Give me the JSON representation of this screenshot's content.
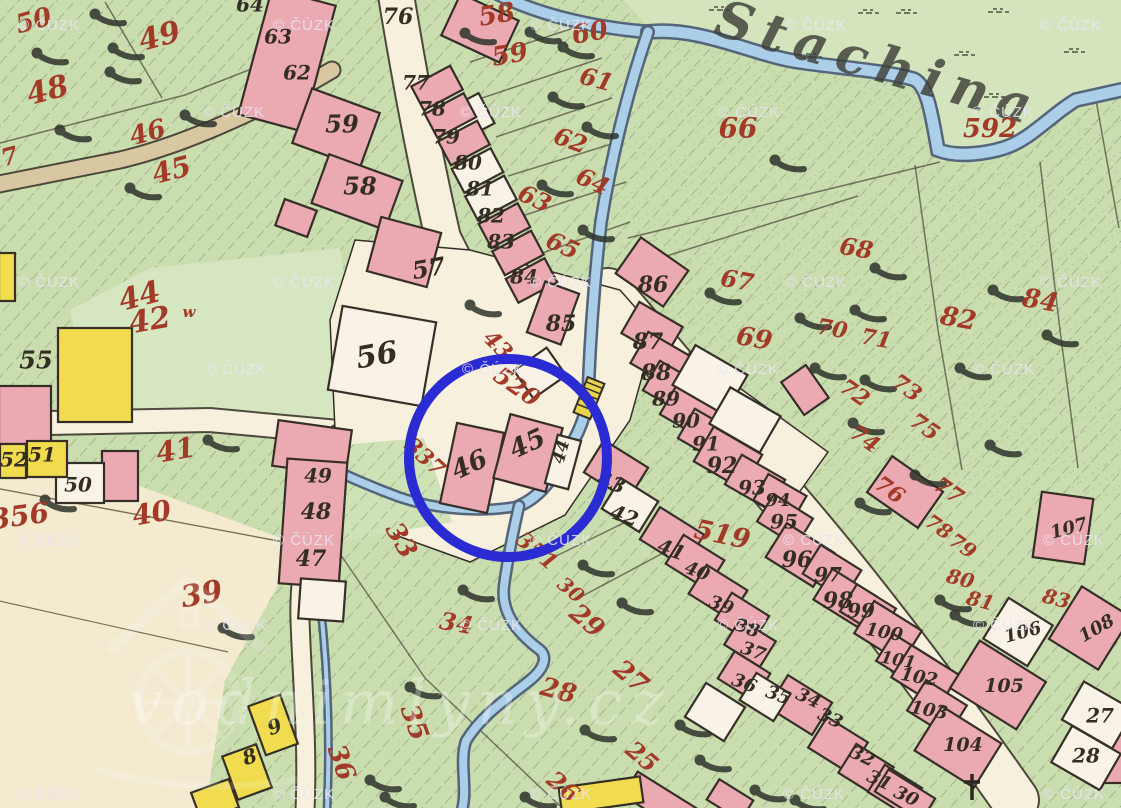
{
  "map": {
    "river_label": "Stachina",
    "site_watermark": "vodnimlyny.cz",
    "copyright_watermark": {
      "text": "© ČÚZK",
      "positions": [
        [
          18,
          18
        ],
        [
          273,
          18
        ],
        [
          530,
          18
        ],
        [
          785,
          18
        ],
        [
          1040,
          18
        ],
        [
          203,
          105
        ],
        [
          460,
          105
        ],
        [
          718,
          105
        ],
        [
          972,
          105
        ],
        [
          18,
          275
        ],
        [
          273,
          275
        ],
        [
          530,
          275
        ],
        [
          785,
          275
        ],
        [
          1040,
          275
        ],
        [
          205,
          362
        ],
        [
          462,
          362
        ],
        [
          717,
          362
        ],
        [
          973,
          362
        ],
        [
          18,
          533
        ],
        [
          273,
          533
        ],
        [
          530,
          533
        ],
        [
          783,
          533
        ],
        [
          1043,
          533
        ],
        [
          205,
          618
        ],
        [
          460,
          618
        ],
        [
          717,
          618
        ],
        [
          973,
          618
        ],
        [
          18,
          787
        ],
        [
          273,
          787
        ],
        [
          530,
          787
        ],
        [
          783,
          787
        ],
        [
          1043,
          787
        ]
      ]
    },
    "annotation_circle": {
      "cx": 508,
      "cy": 458,
      "r": 99,
      "color": "#2b2bd4",
      "stroke_width": 10
    },
    "colors": {
      "paper": "#f7f0dc",
      "field": "#f3ead0",
      "meadow": "#d4e5bd",
      "meadow2": "#d6e6c0",
      "green": "#c9ddae",
      "patch": "#cfe2b6",
      "pink": "#eba9b2",
      "white_bldg": "#f8f3e6",
      "yellow": "#f0dc4e",
      "tan": "#d9c7a2",
      "stream_fill": "#abcfe8",
      "stream_edge": "#54657a",
      "outline": "#352f28",
      "red_ink": "#a33a28",
      "black_ink": "#332d24",
      "watermark": "#e9e5f3",
      "tree": "#2f332c",
      "bridge": "#e8d44d"
    },
    "parcel_numbers_red": [
      {
        "t": "50",
        "x": 34,
        "y": 22,
        "r": -15,
        "s": 26
      },
      {
        "t": "49",
        "x": 160,
        "y": 38,
        "r": -15,
        "s": 30
      },
      {
        "t": "48",
        "x": 48,
        "y": 92,
        "r": -15,
        "s": 30
      },
      {
        "t": "46",
        "x": 148,
        "y": 134,
        "r": -15,
        "s": 26
      },
      {
        "t": "45",
        "x": 172,
        "y": 172,
        "r": -15,
        "s": 28
      },
      {
        "t": "7",
        "x": 10,
        "y": 158,
        "r": -15,
        "s": 24
      },
      {
        "t": "44",
        "x": 140,
        "y": 298,
        "r": -15,
        "s": 30
      },
      {
        "t": "42",
        "x": 150,
        "y": 322,
        "r": -10,
        "s": 30
      },
      {
        "t": "w",
        "x": 189,
        "y": 313,
        "r": 0,
        "s": 15
      },
      {
        "t": "41",
        "x": 176,
        "y": 452,
        "r": -10,
        "s": 28
      },
      {
        "t": "40",
        "x": 152,
        "y": 515,
        "r": -10,
        "s": 28
      },
      {
        "t": "356",
        "x": 20,
        "y": 518,
        "r": -8,
        "s": 28
      },
      {
        "t": "39",
        "x": 202,
        "y": 596,
        "r": -10,
        "s": 30
      },
      {
        "t": "33",
        "x": 400,
        "y": 541,
        "r": 60,
        "s": 26
      },
      {
        "t": "35",
        "x": 413,
        "y": 723,
        "r": 70,
        "s": 26
      },
      {
        "t": "36",
        "x": 340,
        "y": 763,
        "r": 70,
        "s": 26
      },
      {
        "t": "337",
        "x": 424,
        "y": 458,
        "r": 42,
        "s": 22
      },
      {
        "t": "43",
        "x": 497,
        "y": 346,
        "r": 45,
        "s": 22
      },
      {
        "t": "520",
        "x": 516,
        "y": 388,
        "r": 35,
        "s": 24
      },
      {
        "t": "519",
        "x": 722,
        "y": 536,
        "r": 12,
        "s": 27
      },
      {
        "t": "351",
        "x": 536,
        "y": 552,
        "r": 40,
        "s": 22
      },
      {
        "t": "30",
        "x": 570,
        "y": 591,
        "r": 40,
        "s": 20
      },
      {
        "t": "29",
        "x": 586,
        "y": 622,
        "r": 40,
        "s": 26
      },
      {
        "t": "28",
        "x": 558,
        "y": 692,
        "r": 15,
        "s": 26
      },
      {
        "t": "27",
        "x": 630,
        "y": 678,
        "r": 40,
        "s": 26
      },
      {
        "t": "26",
        "x": 562,
        "y": 788,
        "r": 40,
        "s": 24
      },
      {
        "t": "25",
        "x": 641,
        "y": 758,
        "r": 40,
        "s": 24
      },
      {
        "t": "34",
        "x": 456,
        "y": 625,
        "r": 10,
        "s": 24
      },
      {
        "t": "58",
        "x": 497,
        "y": 16,
        "r": -10,
        "s": 26
      },
      {
        "t": "59",
        "x": 510,
        "y": 56,
        "r": -10,
        "s": 26
      },
      {
        "t": "60",
        "x": 590,
        "y": 34,
        "r": -10,
        "s": 26
      },
      {
        "t": "61",
        "x": 596,
        "y": 81,
        "r": 15,
        "s": 24
      },
      {
        "t": "62",
        "x": 570,
        "y": 142,
        "r": 20,
        "s": 24
      },
      {
        "t": "63",
        "x": 534,
        "y": 200,
        "r": 25,
        "s": 24
      },
      {
        "t": "64",
        "x": 592,
        "y": 183,
        "r": 25,
        "s": 24
      },
      {
        "t": "65",
        "x": 562,
        "y": 247,
        "r": 25,
        "s": 24
      },
      {
        "t": "66",
        "x": 738,
        "y": 130,
        "r": 0,
        "s": 28
      },
      {
        "t": "592",
        "x": 990,
        "y": 130,
        "r": 0,
        "s": 26
      },
      {
        "t": "67",
        "x": 737,
        "y": 282,
        "r": 10,
        "s": 24
      },
      {
        "t": "68",
        "x": 856,
        "y": 250,
        "r": 10,
        "s": 24
      },
      {
        "t": "69",
        "x": 754,
        "y": 340,
        "r": 10,
        "s": 26
      },
      {
        "t": "70",
        "x": 832,
        "y": 330,
        "r": 10,
        "s": 22
      },
      {
        "t": "71",
        "x": 876,
        "y": 340,
        "r": 10,
        "s": 22
      },
      {
        "t": "72",
        "x": 854,
        "y": 394,
        "r": 35,
        "s": 22
      },
      {
        "t": "73",
        "x": 906,
        "y": 389,
        "r": 35,
        "s": 22
      },
      {
        "t": "74",
        "x": 864,
        "y": 440,
        "r": 35,
        "s": 22
      },
      {
        "t": "75",
        "x": 924,
        "y": 428,
        "r": 35,
        "s": 22
      },
      {
        "t": "76",
        "x": 889,
        "y": 491,
        "r": 35,
        "s": 22
      },
      {
        "t": "77",
        "x": 948,
        "y": 492,
        "r": 35,
        "s": 22
      },
      {
        "t": "78",
        "x": 938,
        "y": 528,
        "r": 35,
        "s": 20
      },
      {
        "t": "79",
        "x": 962,
        "y": 547,
        "r": 35,
        "s": 20
      },
      {
        "t": "80",
        "x": 960,
        "y": 580,
        "r": 15,
        "s": 20
      },
      {
        "t": "81",
        "x": 980,
        "y": 602,
        "r": 15,
        "s": 20
      },
      {
        "t": "83",
        "x": 1056,
        "y": 600,
        "r": 15,
        "s": 20
      },
      {
        "t": "82",
        "x": 958,
        "y": 320,
        "r": 10,
        "s": 26
      },
      {
        "t": "84",
        "x": 1040,
        "y": 302,
        "r": 10,
        "s": 26
      }
    ],
    "house_numbers_black": [
      {
        "t": "64",
        "x": 250,
        "y": 6,
        "r": 0,
        "s": 20
      },
      {
        "t": "63",
        "x": 278,
        "y": 38,
        "r": 0,
        "s": 20
      },
      {
        "t": "62",
        "x": 297,
        "y": 74,
        "r": 0,
        "s": 20
      },
      {
        "t": "59",
        "x": 342,
        "y": 126,
        "r": 0,
        "s": 24
      },
      {
        "t": "58",
        "x": 360,
        "y": 188,
        "r": 0,
        "s": 24
      },
      {
        "t": "76",
        "x": 398,
        "y": 18,
        "r": 0,
        "s": 22
      },
      {
        "t": "77",
        "x": 416,
        "y": 84,
        "r": 0,
        "s": 20
      },
      {
        "t": "78",
        "x": 432,
        "y": 110,
        "r": 0,
        "s": 20
      },
      {
        "t": "79",
        "x": 446,
        "y": 138,
        "r": 0,
        "s": 20
      },
      {
        "t": "80",
        "x": 468,
        "y": 164,
        "r": 0,
        "s": 20
      },
      {
        "t": "81",
        "x": 480,
        "y": 190,
        "r": 0,
        "s": 20
      },
      {
        "t": "82",
        "x": 491,
        "y": 217,
        "r": 0,
        "s": 20
      },
      {
        "t": "83",
        "x": 501,
        "y": 243,
        "r": 0,
        "s": 20
      },
      {
        "t": "84",
        "x": 524,
        "y": 278,
        "r": 0,
        "s": 20
      },
      {
        "t": "85",
        "x": 561,
        "y": 325,
        "r": 0,
        "s": 22
      },
      {
        "t": "86",
        "x": 653,
        "y": 286,
        "r": 0,
        "s": 22
      },
      {
        "t": "87",
        "x": 648,
        "y": 343,
        "r": 0,
        "s": 22
      },
      {
        "t": "88",
        "x": 656,
        "y": 374,
        "r": 0,
        "s": 22
      },
      {
        "t": "89",
        "x": 666,
        "y": 400,
        "r": 0,
        "s": 20
      },
      {
        "t": "90",
        "x": 686,
        "y": 422,
        "r": 0,
        "s": 20
      },
      {
        "t": "91",
        "x": 706,
        "y": 445,
        "r": 0,
        "s": 20
      },
      {
        "t": "92",
        "x": 722,
        "y": 467,
        "r": 0,
        "s": 22
      },
      {
        "t": "93",
        "x": 752,
        "y": 489,
        "r": 0,
        "s": 20
      },
      {
        "t": "94",
        "x": 778,
        "y": 501,
        "r": 0,
        "s": 18
      },
      {
        "t": "95",
        "x": 784,
        "y": 523,
        "r": 0,
        "s": 20
      },
      {
        "t": "96",
        "x": 797,
        "y": 561,
        "r": 0,
        "s": 22
      },
      {
        "t": "97",
        "x": 828,
        "y": 576,
        "r": 0,
        "s": 20
      },
      {
        "t": "98",
        "x": 838,
        "y": 602,
        "r": 0,
        "s": 22
      },
      {
        "t": "99",
        "x": 861,
        "y": 612,
        "r": 0,
        "s": 20
      },
      {
        "t": "100",
        "x": 884,
        "y": 633,
        "r": 10,
        "s": 18
      },
      {
        "t": "101",
        "x": 898,
        "y": 661,
        "r": 10,
        "s": 17
      },
      {
        "t": "102",
        "x": 919,
        "y": 678,
        "r": 10,
        "s": 18
      },
      {
        "t": "103",
        "x": 929,
        "y": 711,
        "r": 10,
        "s": 18
      },
      {
        "t": "104",
        "x": 963,
        "y": 746,
        "r": 0,
        "s": 19
      },
      {
        "t": "105",
        "x": 1004,
        "y": 687,
        "r": 0,
        "s": 19
      },
      {
        "t": "106",
        "x": 1023,
        "y": 633,
        "r": -15,
        "s": 18
      },
      {
        "t": "107",
        "x": 1069,
        "y": 529,
        "r": -15,
        "s": 18
      },
      {
        "t": "108",
        "x": 1097,
        "y": 629,
        "r": -30,
        "s": 18
      },
      {
        "t": "27",
        "x": 1100,
        "y": 717,
        "r": 0,
        "s": 20
      },
      {
        "t": "28",
        "x": 1086,
        "y": 757,
        "r": 0,
        "s": 20
      },
      {
        "t": "55",
        "x": 36,
        "y": 362,
        "r": 0,
        "s": 24
      },
      {
        "t": "52",
        "x": 14,
        "y": 461,
        "r": 0,
        "s": 20
      },
      {
        "t": "51",
        "x": 42,
        "y": 456,
        "r": 0,
        "s": 20
      },
      {
        "t": "50",
        "x": 78,
        "y": 486,
        "r": 0,
        "s": 20
      },
      {
        "t": "56",
        "x": 377,
        "y": 357,
        "r": -10,
        "s": 30
      },
      {
        "t": "57",
        "x": 429,
        "y": 270,
        "r": -10,
        "s": 24
      },
      {
        "t": "49",
        "x": 318,
        "y": 477,
        "r": 0,
        "s": 20
      },
      {
        "t": "48",
        "x": 316,
        "y": 513,
        "r": 0,
        "s": 22
      },
      {
        "t": "47",
        "x": 311,
        "y": 560,
        "r": 0,
        "s": 22
      },
      {
        "t": "46",
        "x": 470,
        "y": 466,
        "r": -25,
        "s": 26
      },
      {
        "t": "45",
        "x": 528,
        "y": 445,
        "r": -25,
        "s": 26
      },
      {
        "t": "44",
        "x": 562,
        "y": 452,
        "r": -75,
        "s": 17
      },
      {
        "t": "43",
        "x": 611,
        "y": 484,
        "r": 20,
        "s": 20
      },
      {
        "t": "42",
        "x": 624,
        "y": 517,
        "r": 20,
        "s": 20
      },
      {
        "t": "41",
        "x": 671,
        "y": 551,
        "r": 20,
        "s": 20
      },
      {
        "t": "40",
        "x": 697,
        "y": 572,
        "r": 20,
        "s": 18
      },
      {
        "t": "39",
        "x": 721,
        "y": 606,
        "r": 20,
        "s": 18
      },
      {
        "t": "38",
        "x": 747,
        "y": 629,
        "r": 20,
        "s": 18
      },
      {
        "t": "37",
        "x": 753,
        "y": 652,
        "r": 20,
        "s": 18
      },
      {
        "t": "36",
        "x": 744,
        "y": 684,
        "r": 20,
        "s": 18
      },
      {
        "t": "35",
        "x": 778,
        "y": 696,
        "r": 20,
        "s": 18
      },
      {
        "t": "34",
        "x": 808,
        "y": 699,
        "r": 25,
        "s": 18
      },
      {
        "t": "33",
        "x": 830,
        "y": 719,
        "r": 25,
        "s": 18
      },
      {
        "t": "32",
        "x": 862,
        "y": 757,
        "r": 25,
        "s": 18
      },
      {
        "t": "31",
        "x": 879,
        "y": 781,
        "r": 25,
        "s": 18
      },
      {
        "t": "30",
        "x": 906,
        "y": 797,
        "r": 25,
        "s": 18
      },
      {
        "t": "9",
        "x": 275,
        "y": 728,
        "r": -20,
        "s": 20
      },
      {
        "t": "8",
        "x": 250,
        "y": 758,
        "r": -20,
        "s": 20
      }
    ],
    "trees": [
      [
        95,
        14
      ],
      [
        113,
        48
      ],
      [
        37,
        53
      ],
      [
        110,
        72
      ],
      [
        60,
        130
      ],
      [
        185,
        115
      ],
      [
        130,
        188
      ],
      [
        208,
        440
      ],
      [
        45,
        500
      ],
      [
        465,
        33
      ],
      [
        530,
        32
      ],
      [
        563,
        47
      ],
      [
        553,
        97
      ],
      [
        587,
        127
      ],
      [
        542,
        185
      ],
      [
        583,
        230
      ],
      [
        470,
        305
      ],
      [
        775,
        160
      ],
      [
        710,
        293
      ],
      [
        800,
        318
      ],
      [
        855,
        310
      ],
      [
        815,
        368
      ],
      [
        865,
        380
      ],
      [
        853,
        423
      ],
      [
        860,
        503
      ],
      [
        875,
        268
      ],
      [
        960,
        368
      ],
      [
        993,
        290
      ],
      [
        1047,
        335
      ],
      [
        915,
        475
      ],
      [
        990,
        445
      ],
      [
        223,
        628
      ],
      [
        463,
        590
      ],
      [
        410,
        687
      ],
      [
        370,
        780
      ],
      [
        583,
        565
      ],
      [
        622,
        603
      ],
      [
        585,
        730
      ],
      [
        680,
        725
      ],
      [
        700,
        760
      ],
      [
        755,
        790
      ],
      [
        940,
        600
      ],
      [
        955,
        615
      ],
      [
        385,
        797
      ],
      [
        525,
        797
      ],
      [
        795,
        800
      ]
    ],
    "grass_tufts": [
      [
        718,
        10
      ],
      [
        810,
        57
      ],
      [
        867,
        13
      ],
      [
        997,
        12
      ],
      [
        963,
        55
      ],
      [
        993,
        97
      ],
      [
        1073,
        52
      ],
      [
        905,
        13
      ]
    ]
  }
}
